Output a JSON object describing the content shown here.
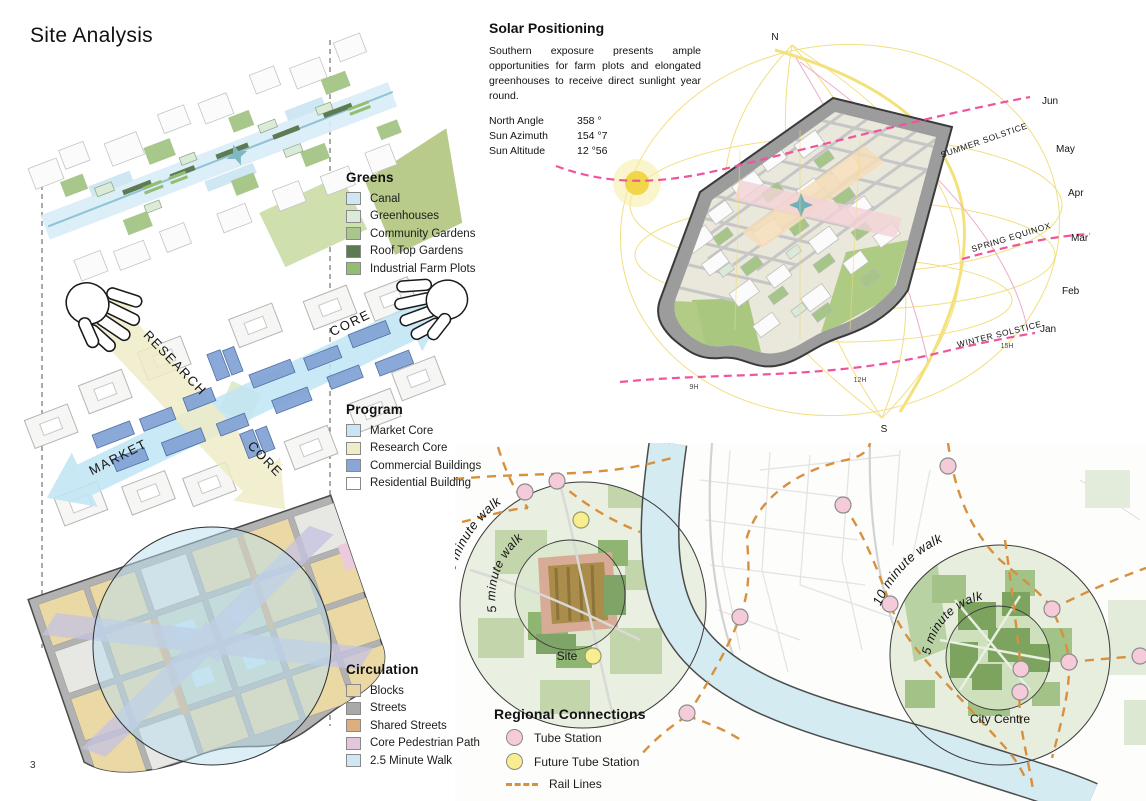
{
  "page": {
    "title": "Site Analysis",
    "number": "3"
  },
  "legends": {
    "greens": {
      "title": "Greens",
      "items": [
        {
          "label": "Canal",
          "color": "#cfe7f3"
        },
        {
          "label": "Greenhouses",
          "color": "#dcebd8"
        },
        {
          "label": "Community Gardens",
          "color": "#a8c78a"
        },
        {
          "label": "Roof Top Gardens",
          "color": "#5d7a52"
        },
        {
          "label": "Industrial Farm Plots",
          "color": "#93bd73"
        }
      ]
    },
    "program": {
      "title": "Program",
      "items": [
        {
          "label": "Market Core",
          "color": "#c7e5f4"
        },
        {
          "label": "Research Core",
          "color": "#efedc7"
        },
        {
          "label": "Commercial Buildings",
          "color": "#8aa6d8"
        },
        {
          "label": "Residential Building",
          "color": "#ffffff"
        }
      ]
    },
    "circulation": {
      "title": "Circulation",
      "items": [
        {
          "label": "Blocks",
          "color": "#e7d6a1"
        },
        {
          "label": "Streets",
          "color": "#a9a9a9"
        },
        {
          "label": "Shared Streets",
          "color": "#dfae7e"
        },
        {
          "label": "Core Pedestrian Path",
          "color": "#e3c6da"
        },
        {
          "label": "2.5 Minute Walk",
          "color": "#cfe7f3"
        }
      ]
    },
    "regional": {
      "title": "Regional Connections",
      "items": [
        {
          "label": "Tube Station",
          "color": "#f5cbd9"
        },
        {
          "label": "Future Tube Station",
          "color": "#f8ee90"
        },
        {
          "label": "Rail Lines",
          "color": "#d8903e"
        }
      ]
    }
  },
  "program_diagram": {
    "labels": {
      "research": "RESEARCH",
      "core_blue": "CORE",
      "market": "MARKET",
      "core_yellow": "CORE"
    }
  },
  "solar": {
    "title": "Solar Positioning",
    "description": "Southern exposure presents ample opportunities for farm plots and elongated greenhouses to receive direct sunlight year round.",
    "stats": [
      {
        "label": "North Angle",
        "value": "358 °"
      },
      {
        "label": "Sun Azimuth",
        "value": "154 °7"
      },
      {
        "label": "Sun Altitude",
        "value": "12 °56"
      }
    ],
    "compass": {
      "north": "N",
      "south": "S"
    },
    "months": [
      "Jun",
      "May",
      "Apr",
      "Mar",
      "Feb",
      "Jan"
    ],
    "paths": {
      "summer": "SUMMER SOLSTICE",
      "spring": "SPRING EQUINOX",
      "winter": "WINTER SOLSTICE"
    },
    "hours": [
      "9H",
      "12H",
      "15H"
    ],
    "accents": {
      "sun": "#f1d64a",
      "solstice_path": "#f0549e",
      "sun_path": "#f0dc74"
    }
  },
  "map": {
    "site_circle": {
      "outer_label": "10 minute walk",
      "inner_label": "5 minute walk",
      "name": "Site"
    },
    "centre_circle": {
      "outer_label": "10 minute walk",
      "inner_label": "5 minute walk",
      "name": "City Centre"
    },
    "river_color": "#d3ebf1"
  }
}
